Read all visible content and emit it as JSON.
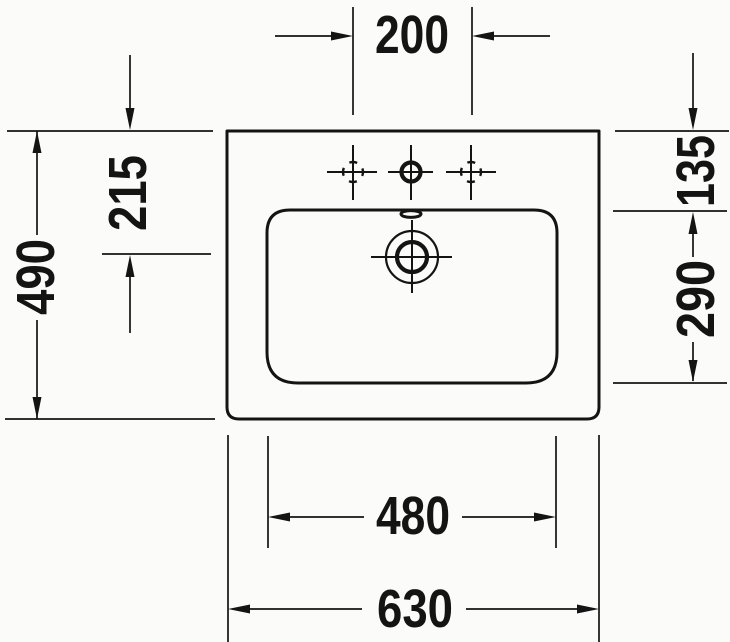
{
  "drawing": {
    "subject": "washbasin-top-view-technical-drawing",
    "line_color": "#141414",
    "background_color": "#fbfbf9",
    "dimensions": {
      "tap_spacing": "200",
      "overall_depth": "490",
      "drain_from_rear": "215",
      "rim_to_basin": "135",
      "basin_depth": "290",
      "basin_width": "480",
      "overall_width": "630"
    }
  }
}
